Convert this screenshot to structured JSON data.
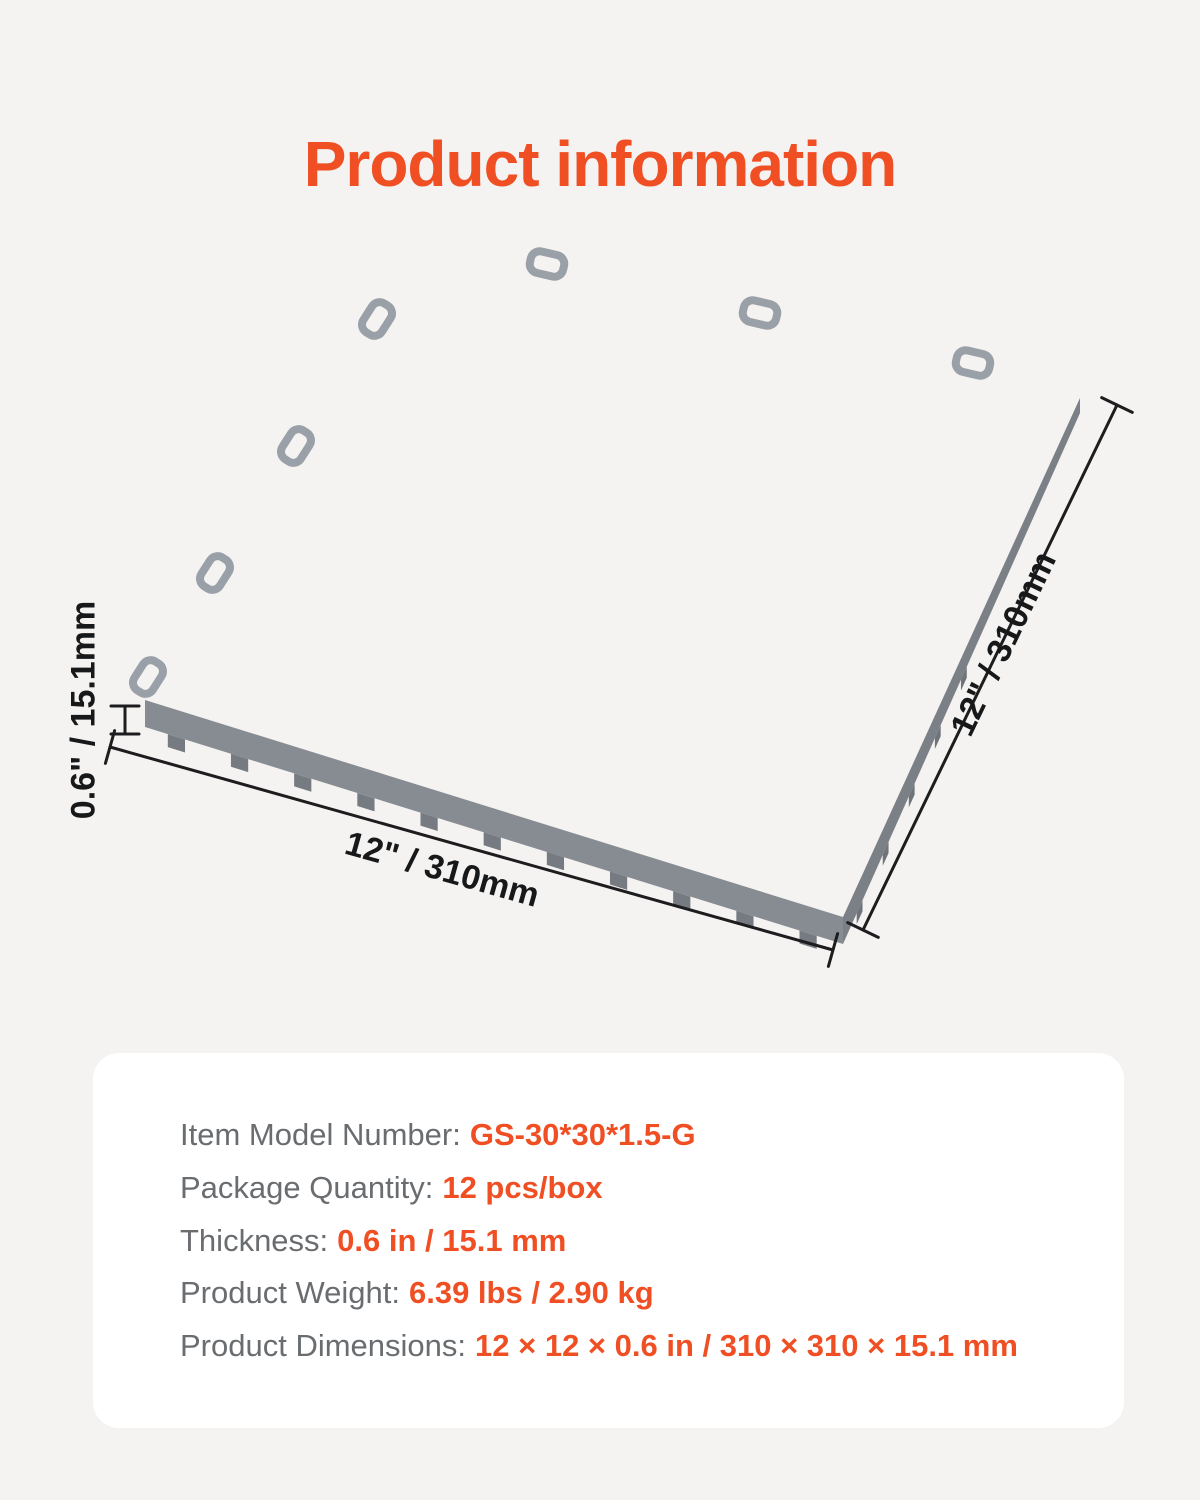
{
  "title": "Product information",
  "accent_color": "#F04E23",
  "tile": {
    "description": "gray interlocking vented garage floor tile, 3d perspective view",
    "top_color": "#9aa0a8",
    "shadow_color": "#6e737a",
    "highlight_color": "#c0c4c9",
    "side_color": "#878c93"
  },
  "dimensions": {
    "bottom": "12\" / 310mm",
    "right": "12\" / 310mm",
    "thickness": "0.6\" / 15.1mm"
  },
  "specs": {
    "rows": [
      {
        "label": "Item Model Number:",
        "value": "GS-30*30*1.5-G"
      },
      {
        "label": "Package Quantity:",
        "value": "12 pcs/box"
      },
      {
        "label": "Thickness:",
        "value": "0.6 in / 15.1 mm"
      },
      {
        "label": "Product Weight:",
        "value": "6.39 lbs / 2.90 kg"
      },
      {
        "label": "Product Dimensions:",
        "value": "12 × 12 × 0.6 in / 310 × 310 × 15.1 mm"
      }
    ]
  }
}
